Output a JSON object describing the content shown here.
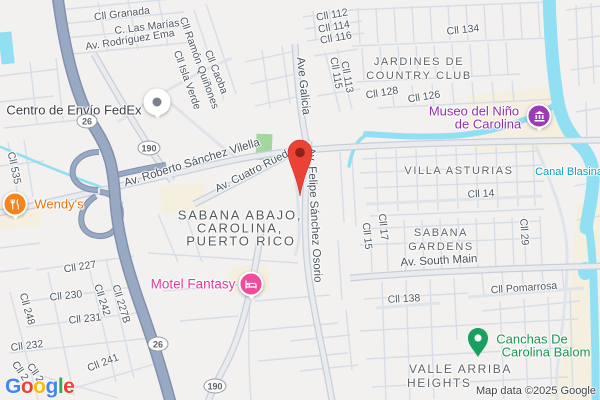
{
  "attribution": "Map data ©2025 Google",
  "logo": {
    "letters": [
      {
        "ch": "G",
        "style": "color:#4285F4"
      },
      {
        "ch": "o",
        "style": "color:#EA4335"
      },
      {
        "ch": "o",
        "style": "color:#FBBC05"
      },
      {
        "ch": "g",
        "style": "color:#4285F4"
      },
      {
        "ch": "l",
        "style": "color:#34A853"
      },
      {
        "ch": "e",
        "style": "color:#EA4335"
      }
    ]
  },
  "routes": {
    "r26": "26",
    "r190": "190"
  },
  "streets": {
    "granada": "Cll Granada",
    "las_marias": "C. Las Marías",
    "rodriguez_ema": "Av. Rodríguez Ema",
    "ramon_quinones": "Cll Ramón Quiñones",
    "isla_verde": "Cll Isla Verde",
    "caoba": "Cll Caoba",
    "c535": "Cll 535",
    "c112": "Cll 112",
    "c114": "Cll 114",
    "c116": "Cll 116",
    "c115": "Cll 115",
    "c113": "Cll 113",
    "ave_galicia": "Ave Galicia",
    "c134": "Cll 134",
    "c128": "Cll 128",
    "c126": "Cll 126",
    "roberto_sanchez": "Av. Roberto Sánchez Vilella",
    "cuatro_ruedas": "Av. Cuatro Ruedas",
    "felipe_sanchez": "Av. Felipe Sánchez Osorio",
    "partial_c": "C",
    "c14": "Cll 14",
    "c15": "Cll 15",
    "c17": "Cll 17",
    "c29": "Cll 29",
    "south_main": "Av. South Main",
    "c227": "Cll 227",
    "c230": "Cll 230",
    "c242": "Cll 242",
    "c227b": "Cll 227B",
    "c248": "Cll 248",
    "c231": "Cll 231",
    "c232": "Cll 232",
    "c241": "Cll 241",
    "partial_a": "Cll 2",
    "partial_b": "Cll 2",
    "c138": "Cll 138",
    "pomarrosa": "Cll Pomarrosa"
  },
  "areas": {
    "jardines1": "JARDINES DE",
    "jardines2": "COUNTRY CLUB",
    "villa_asturias": "VILLA ASTURIAS",
    "sabana_gardens1": "SABANA",
    "sabana_gardens2": "GARDENS",
    "valle1": "VALLE ARRIBA",
    "valle2": "HEIGHTS",
    "city1": "SABANA ABAJO,",
    "city2": "CAROLINA,",
    "city3": "PUERTO RICO",
    "canal": "Canal Blasina"
  },
  "pois": {
    "fedex": "Centro de Envío FedEx",
    "wendys": "Wendy's",
    "motel": "Motel Fantasy",
    "museo1": "Museo del Niño",
    "museo2": "de Carolina",
    "canchas1": "Canchas De",
    "canchas2": "Carolina Balom"
  },
  "colors": {
    "water": "#90dff2",
    "land": "#f2f1ef",
    "highway": "#98a9c4",
    "park": "#a3d7a0",
    "landmark_area": "#f4efdf",
    "destination_pin": "#EA4335",
    "museum": "#9d3bb4",
    "lodging": "#ee4d9b",
    "restaurant": "#f5841f",
    "sports_green": "#17a05e",
    "logo_blue": "#4285F4",
    "logo_red": "#EA4335",
    "logo_yellow": "#FBBC05",
    "logo_green": "#34A853"
  }
}
